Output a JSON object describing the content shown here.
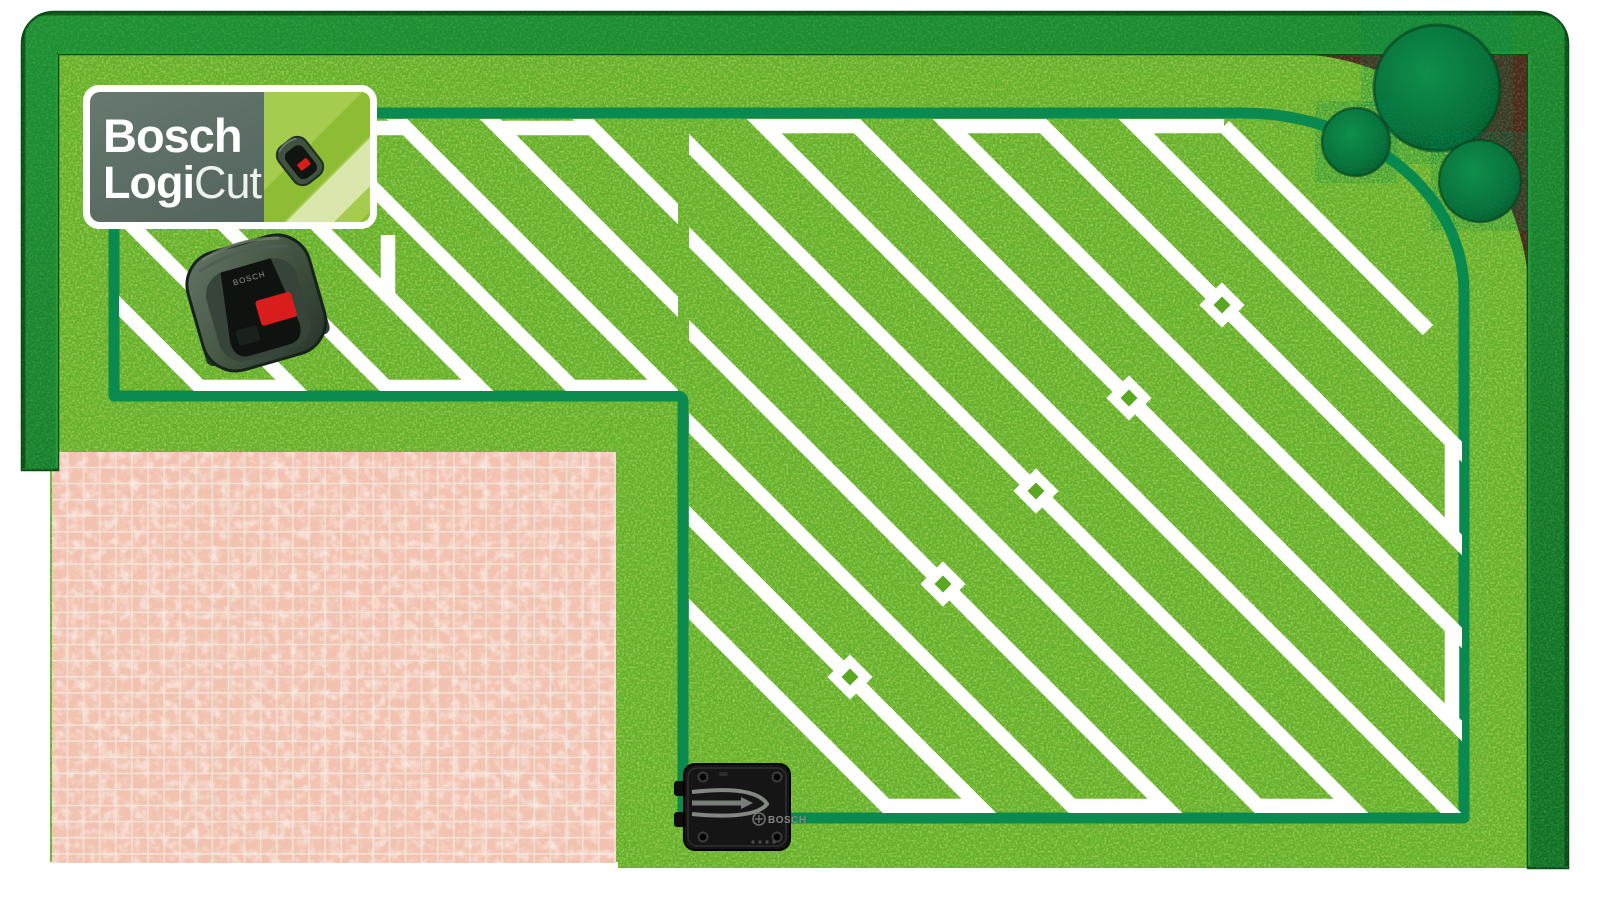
{
  "illustration": {
    "title": "Bosch LogiCut robotic mower garden plan",
    "badge": {
      "brand": "Bosch",
      "product_bold": "Logi",
      "product_light": "Cut"
    },
    "charging_station_label": "BOSCH",
    "mower_label": "BOSCH"
  },
  "colors": {
    "grass": "#61ae27",
    "grass_dark": "#4a8c1a",
    "grass_speckle": "#c4e04a",
    "hedge": "#128028",
    "hedge_dark": "#084d16",
    "hedge_light": "#27a337",
    "wire": "#0a8a4e",
    "path_white": "#ffffff",
    "patio": "#f4c2b0",
    "patio_grout": "#f6efe9",
    "soil": "#45291b",
    "bush": "#0c7a3e",
    "badge_sage": "#5b6d64",
    "badge_green": "#a6cc4f",
    "badge_green_pale": "#d9e7ac",
    "mower_body": "#4e5f51",
    "mower_button_red": "#d91c1c",
    "station_black": "#151515"
  },
  "icons": {
    "robot_mower": "top-down robotic lawn mower",
    "robot_mower_small": "small robotic mower on badge",
    "charging_station": "mower charging base plate",
    "bush": "round trimmed shrub",
    "flower_bed": "corner soil bed",
    "perimeter_wire": "green boundary wire loop",
    "mowing_path": "white diagonal mowing lanes"
  }
}
